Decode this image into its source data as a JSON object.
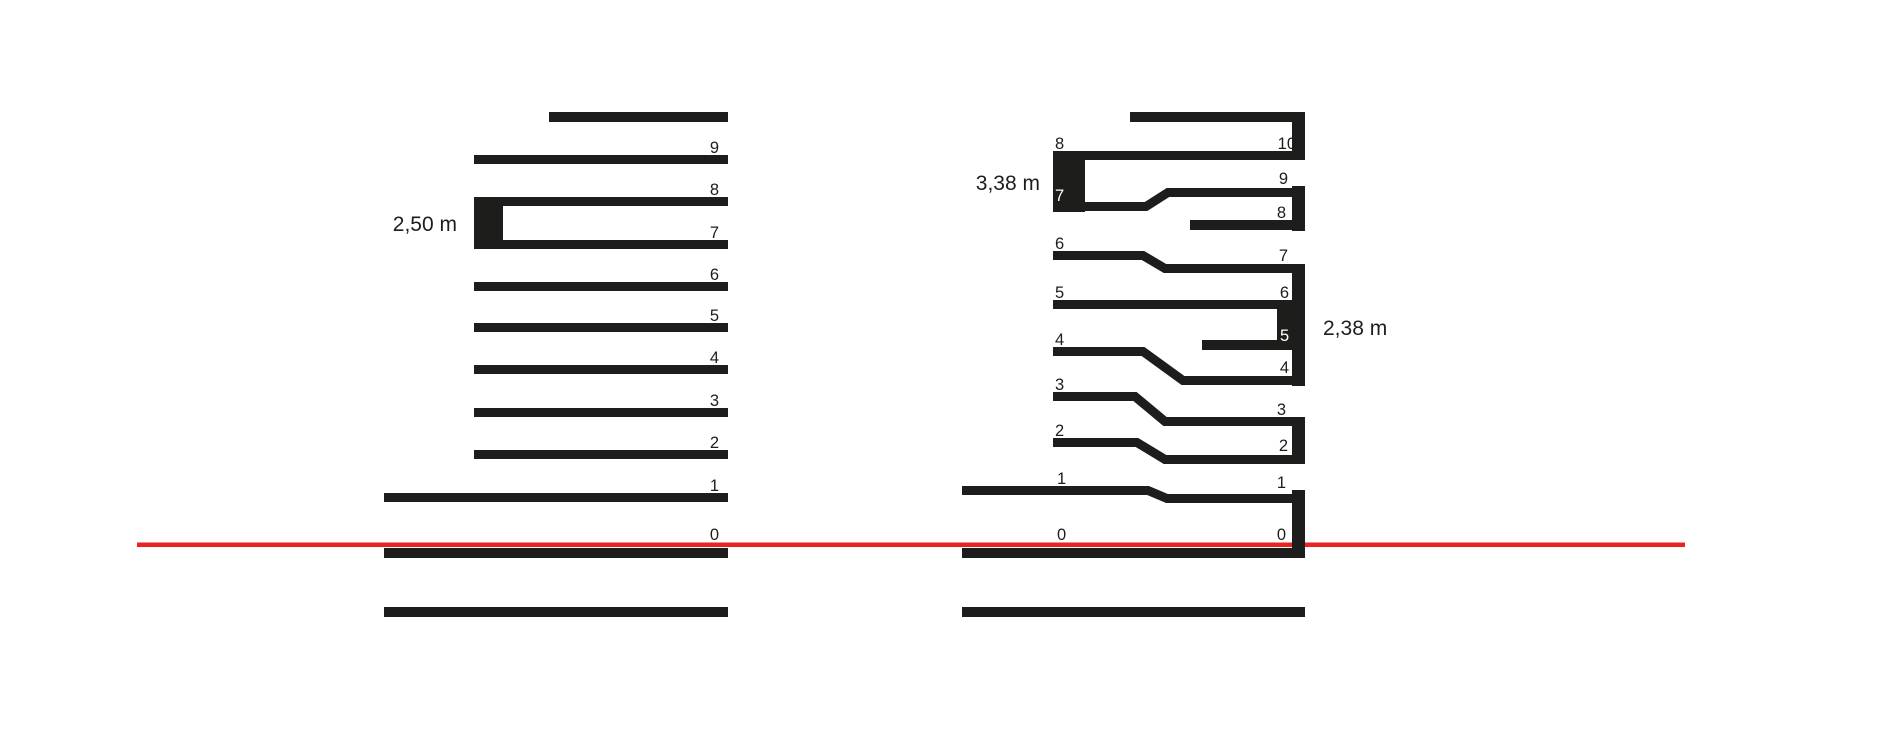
{
  "colors": {
    "ink": "#1d1d1b",
    "datum_red": "#e82320",
    "paper": "#ffffff"
  },
  "left_building": {
    "height_label": "2,50 m",
    "floor_labels": [
      "0",
      "1",
      "2",
      "3",
      "4",
      "5",
      "6",
      "7",
      "8",
      "9"
    ]
  },
  "right_building": {
    "left_height_label": "3,38 m",
    "right_height_label": "2,38 m",
    "left_floor_labels": [
      "0",
      "1",
      "2",
      "3",
      "4",
      "5",
      "6",
      "7",
      "8"
    ],
    "right_floor_labels": [
      "0",
      "1",
      "2",
      "3",
      "4",
      "5",
      "6",
      "7",
      "8",
      "9",
      "10"
    ]
  }
}
